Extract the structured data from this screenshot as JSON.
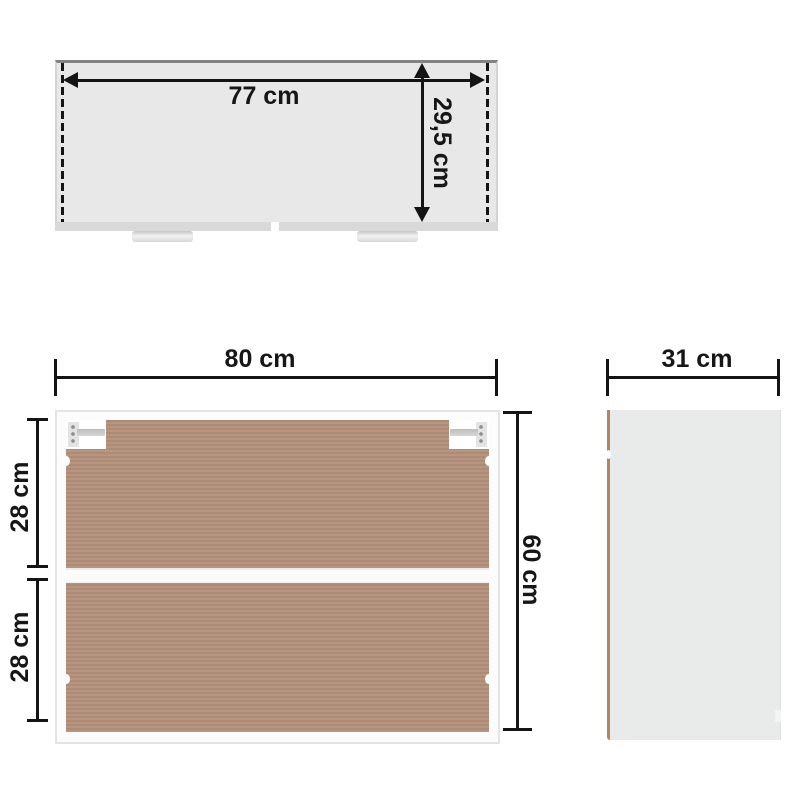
{
  "diagram": {
    "product": "wall-cabinet-dimension-diagram",
    "views": {
      "top": {
        "name": "top-view",
        "width_label": "77 cm",
        "depth_label": "29,5 cm"
      },
      "front": {
        "name": "front-view",
        "width_label": "80 cm",
        "height_label": "60 cm",
        "upper_section_label": "28 cm",
        "lower_section_label": "28 cm"
      },
      "side": {
        "name": "side-view",
        "depth_label": "31 cm"
      }
    },
    "colors": {
      "background": "#ffffff",
      "dimension_line": "#141414",
      "label_text": "#161616",
      "top_panel_fill": "#e8e8e8",
      "top_panel_edge": "#828282",
      "top_front_band": "#d9d9d9",
      "board_brown": "#b3907a",
      "cabinet_frame": "#fcfcfc",
      "frame_edge": "#e4e4e4",
      "side_panel_fill": "#e9eaea",
      "side_edge_tan": "#ab8768",
      "hinge_gray": "#d6d6d6"
    }
  }
}
